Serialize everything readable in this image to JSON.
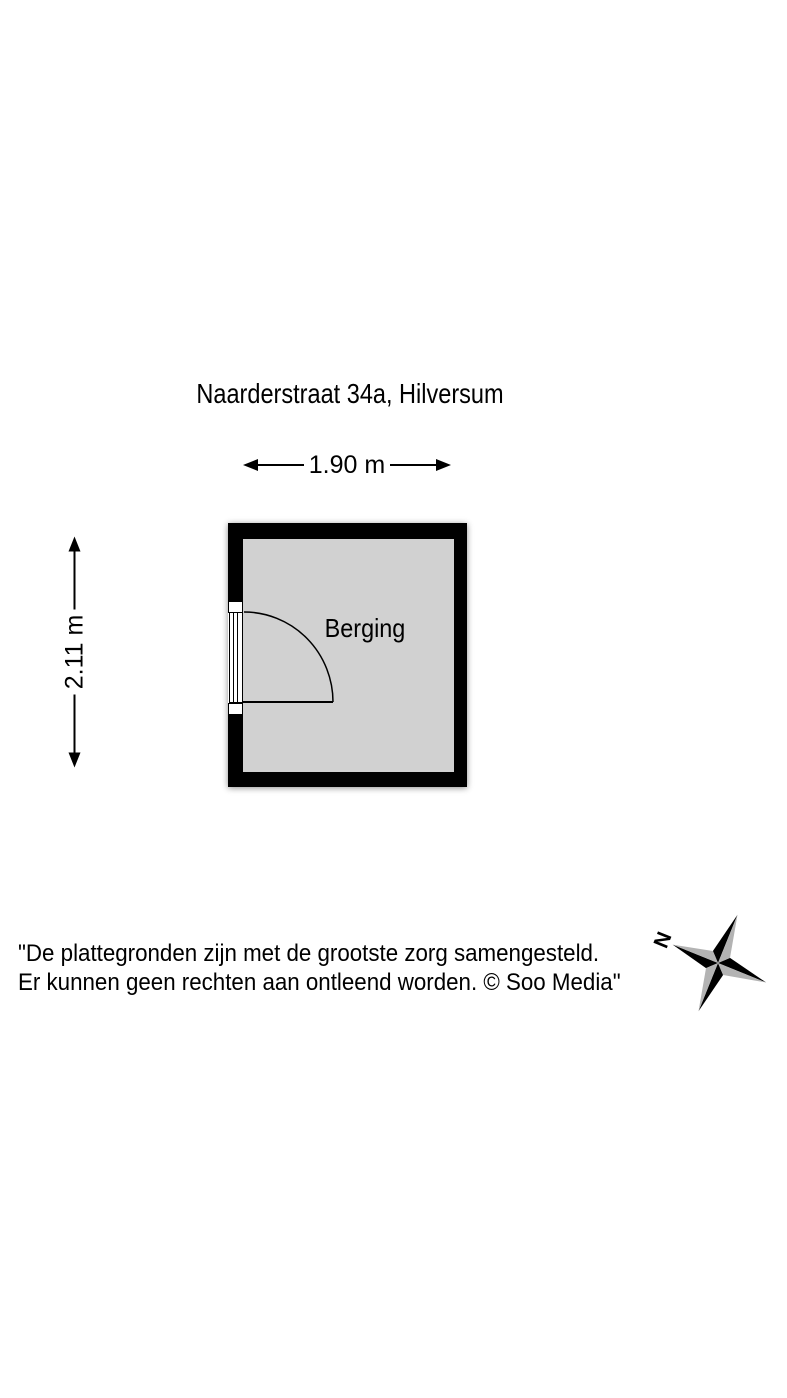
{
  "title": "Naarderstraat 34a, Hilversum",
  "floorplan": {
    "room_label": "Berging",
    "width_dimension": "1.90 m",
    "height_dimension": "2.11 m",
    "features": {
      "door": "hinged-door-with-quarter-circle-swing-into-room-on-left-wall"
    }
  },
  "disclaimer": {
    "line1": "\"De plattegronden zijn met de grootste zorg samengesteld.",
    "line2": "Er kunnen geen rechten aan ontleend worden. © Soo Media\""
  },
  "compass": {
    "north_label": "N"
  },
  "icons": [
    "arrowhead-left-icon",
    "arrowhead-right-icon",
    "door-swing-arc-icon",
    "compass-rose-icon"
  ],
  "colors": {
    "wall": "#000000",
    "floor": "#d1d1d1",
    "door_fill": "#ffffff",
    "compass_gray": "#b3b3b3",
    "text": "#000000",
    "background": "#ffffff"
  }
}
